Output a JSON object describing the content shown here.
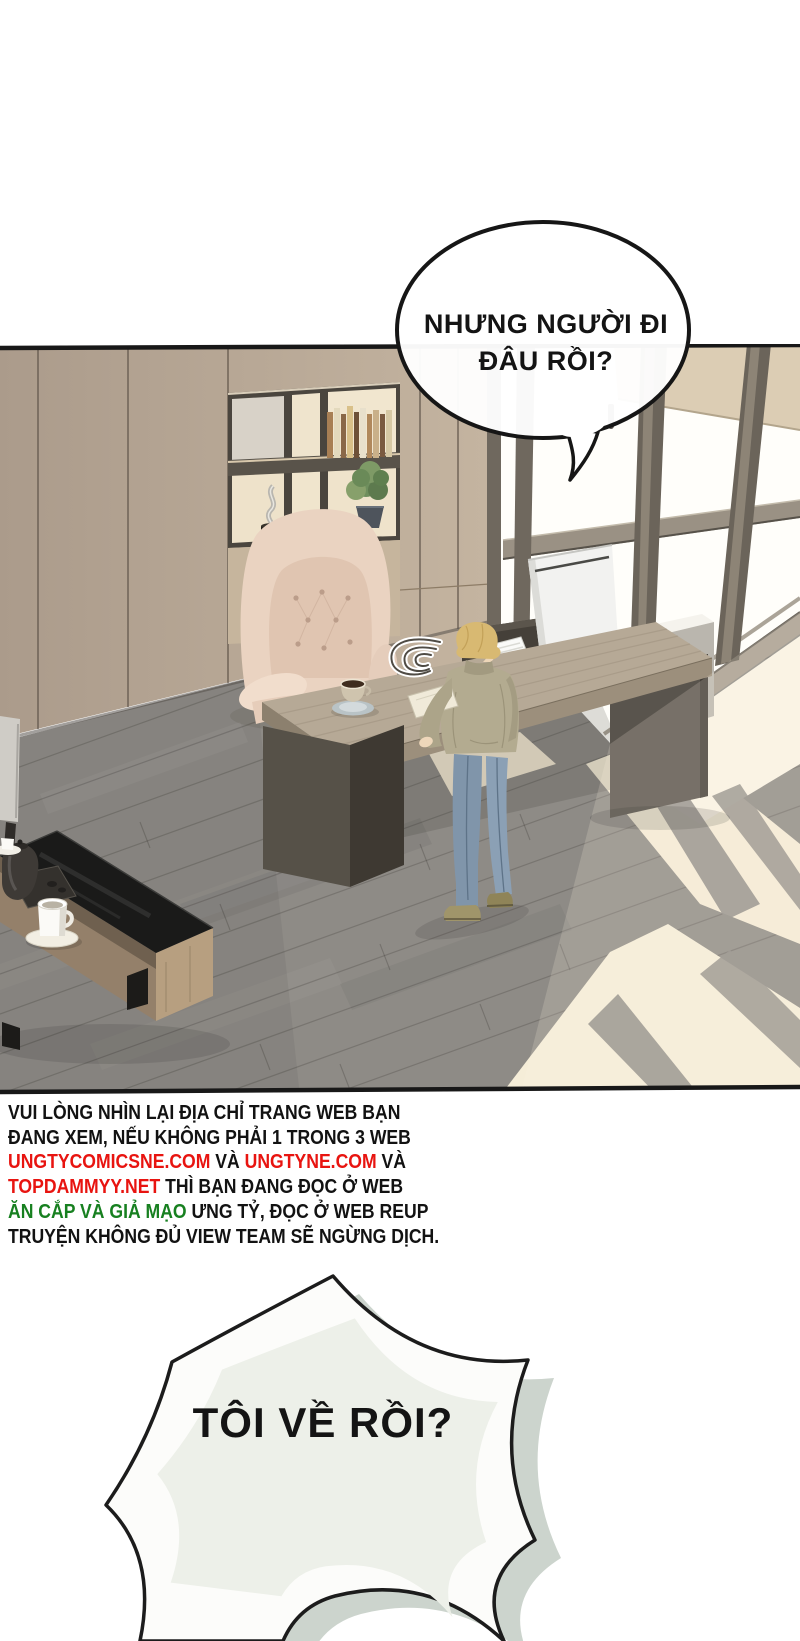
{
  "page": {
    "type": "comic-page",
    "background": "#ffffff"
  },
  "speech_bubble_top": {
    "lines": [
      "NHƯNG NGƯỜI ĐI",
      "ĐÂU RỒI?"
    ]
  },
  "speech_bubble_burst": {
    "text": "TÔI VỀ RỒI?"
  },
  "warning": {
    "lines": [
      {
        "segments": [
          {
            "text": "VUI LÒNG NHÌN LẠI ĐỊA CHỈ TRANG WEB BẠN",
            "color": "#121212"
          }
        ]
      },
      {
        "segments": [
          {
            "text": "ĐANG XEM, NẾU KHÔNG PHẢI 1 TRONG 3 WEB",
            "color": "#121212"
          }
        ]
      },
      {
        "segments": [
          {
            "text": "UNGTYCOMICSNE.COM",
            "color": "#e81410"
          },
          {
            "text": " VÀ ",
            "color": "#121212"
          },
          {
            "text": "UNGTYNE.COM",
            "color": "#e81410"
          },
          {
            "text": " VÀ",
            "color": "#121212"
          }
        ]
      },
      {
        "segments": [
          {
            "text": "TOPDAMMYY.NET",
            "color": "#e81410"
          },
          {
            "text": " THÌ BẠN ĐANG ĐỌC Ở WEB",
            "color": "#121212"
          }
        ]
      },
      {
        "segments": [
          {
            "text": "ĂN CẮP VÀ GIẢ MẠO",
            "color": "#178020"
          },
          {
            "text": " ƯNG TỶ, ĐỌC Ở WEB REUP",
            "color": "#121212"
          }
        ]
      },
      {
        "segments": [
          {
            "text": "TRUYỆN KHÔNG ĐỦ VIEW TEAM SẼ NGỪNG DỊCH.",
            "color": "#121212"
          }
        ]
      }
    ]
  },
  "colors": {
    "outline_black": "#161616",
    "warning_red": "#e81410",
    "warning_green": "#178020",
    "bubble_fill": "#ffffff",
    "burst_shadow": "#ccd4cd",
    "burst_inner": "#edf0e9",
    "wall_wood": "#b7a795",
    "floor_gray": "#8e8b86",
    "sunlight": "#f4ebd6",
    "desk_wood": "#b6a996",
    "chair_beige": "#ead3c1",
    "jeans_blue": "#8095aa",
    "sweater_olive": "#b3ab90",
    "hair_blond": "#d8b972"
  }
}
